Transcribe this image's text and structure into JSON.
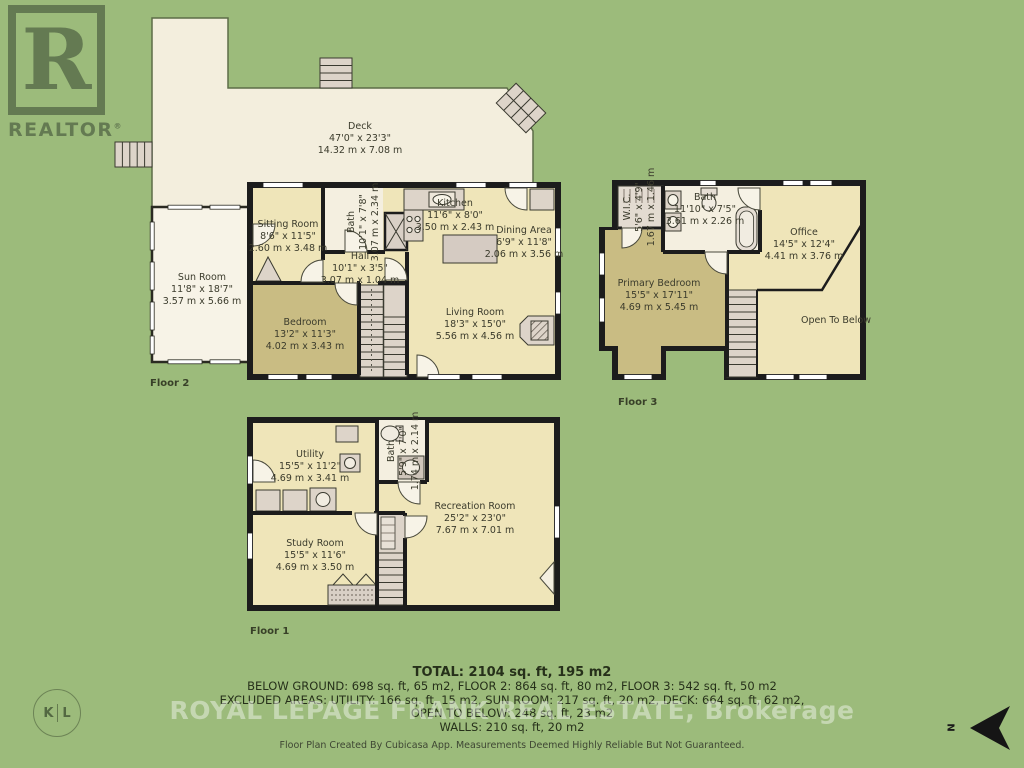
{
  "realtor": {
    "letter": "R",
    "label": "REALTOR",
    "reg": "®"
  },
  "brokerage_watermark": "ROYAL LEPAGE FRANK REAL ESTATE, Brokerage",
  "kl_badge": {
    "k": "K",
    "l": "L"
  },
  "compass": {
    "n": "N"
  },
  "floors": {
    "floor2": {
      "label": "Floor 2",
      "rooms": {
        "deck": {
          "name": "Deck",
          "ft": "47'0\" x 23'3\"",
          "m": "14.32 m x 7.08 m"
        },
        "sun_room": {
          "name": "Sun Room",
          "ft": "11'8\" x 18'7\"",
          "m": "3.57 m x 5.66 m"
        },
        "sitting_room": {
          "name": "Sitting Room",
          "ft": "8'6\" x 11'5\"",
          "m": "2.60 m x 3.48 m"
        },
        "bath": {
          "name": "Bath",
          "ft": "10'1\" x 7'8\"",
          "m": "3.07 m x 2.34 m"
        },
        "kitchen": {
          "name": "Kitchen",
          "ft": "11'6\" x 8'0\"",
          "m": "3.50 m x 2.43 m"
        },
        "dining_area": {
          "name": "Dining Area",
          "ft": "6'9\" x 11'8\"",
          "m": "2.06 m x 3.56 m"
        },
        "hall": {
          "name": "Hall",
          "ft": "10'1\" x 3'5\"",
          "m": "3.07 m x 1.04 m"
        },
        "bedroom": {
          "name": "Bedroom",
          "ft": "13'2\" x 11'3\"",
          "m": "4.02 m x 3.43 m"
        },
        "living_room": {
          "name": "Living Room",
          "ft": "18'3\" x 15'0\"",
          "m": "5.56 m x 4.56 m"
        }
      }
    },
    "floor3": {
      "label": "Floor 3",
      "rooms": {
        "wic": {
          "name": "W.I.C.",
          "ft": "5'6\" x 4'9\"",
          "m": "1.67 m x 1.46 m"
        },
        "bath": {
          "name": "Bath",
          "ft": "11'10\" x 7'5\"",
          "m": "3.61 m x 2.26 m"
        },
        "office": {
          "name": "Office",
          "ft": "14'5\" x 12'4\"",
          "m": "4.41 m x 3.76 m"
        },
        "primary_bedroom": {
          "name": "Primary Bedroom",
          "ft": "15'5\" x 17'11\"",
          "m": "4.69 m x 5.45 m"
        },
        "open_to_below": {
          "name": "Open To Below"
        }
      }
    },
    "floor1": {
      "label": "Floor 1",
      "rooms": {
        "utility": {
          "name": "Utility",
          "ft": "15'5\" x 11'2\"",
          "m": "4.69 m x 3.41 m"
        },
        "bath": {
          "name": "Bath",
          "ft": "5'9\" x 7'0\"",
          "m": "1.74 m x 2.14 m"
        },
        "recreation_room": {
          "name": "Recreation Room",
          "ft": "25'2\" x 23'0\"",
          "m": "7.67 m x 7.01 m"
        },
        "study_room": {
          "name": "Study Room",
          "ft": "15'5\" x 11'6\"",
          "m": "4.69 m x 3.50 m"
        }
      }
    }
  },
  "summary": {
    "total": "TOTAL: 2104 sq. ft, 195 m2",
    "line2": "BELOW GROUND: 698 sq. ft, 65 m2, FLOOR 2: 864 sq. ft, 80 m2, FLOOR 3: 542 sq. ft, 50 m2",
    "line3": "EXCLUDED AREAS: UTILITY: 166 sq. ft, 15 m2, SUN ROOM: 217 sq. ft, 20 m2, DECK: 664 sq. ft, 62 m2,",
    "line4": "OPEN TO BELOW: 248 sq. ft, 23 m2",
    "line5": "WALLS: 210 sq. ft, 20 m2"
  },
  "footer": "Floor Plan Created By Cubicasa App. Measurements Deemed Highly Reliable But Not Guaranteed."
}
